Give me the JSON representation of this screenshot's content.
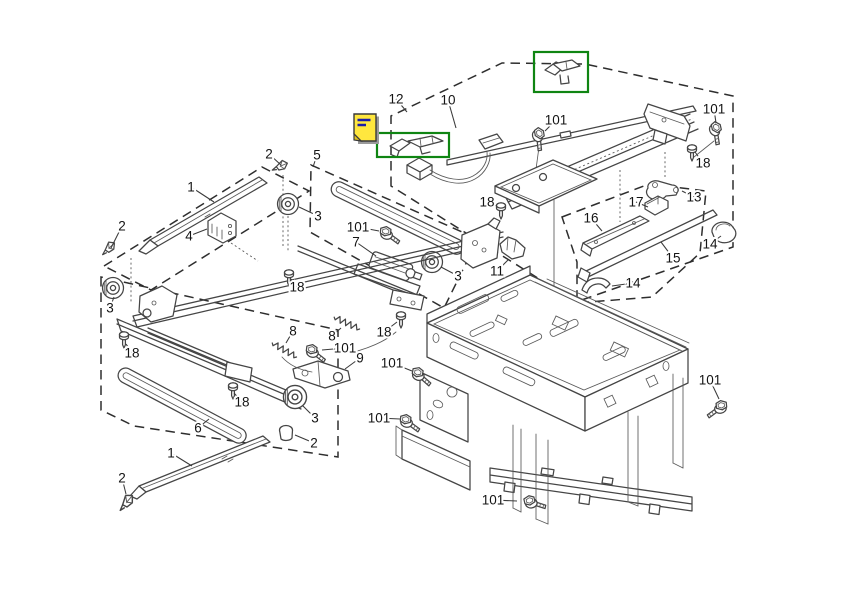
{
  "diagram": {
    "canvas": {
      "width": 842,
      "height": 595,
      "background": "#ffffff",
      "line_color": "#454545",
      "dash_color": "#2e2e2e"
    },
    "highlight_color": "#0f8512",
    "note_icon": {
      "name": "sticky-note-icon",
      "fill": "#ffe73e",
      "shadow": "#9a9a9a",
      "line_color": "#1c1ca8",
      "x": 354,
      "y": 114
    },
    "highlight_boxes": [
      {
        "x": 534,
        "y": 52,
        "w": 54,
        "h": 40
      },
      {
        "x": 377,
        "y": 133,
        "w": 72,
        "h": 24
      }
    ],
    "part_numbers_shown": [
      "1",
      "2",
      "3",
      "4",
      "5",
      "6",
      "7",
      "8",
      "9",
      "10",
      "11",
      "12",
      "13",
      "14",
      "15",
      "16",
      "17",
      "18",
      "101"
    ],
    "callouts": [
      {
        "text": "12",
        "x": 396,
        "y": 99,
        "lx": 407,
        "ly": 112
      },
      {
        "text": "10",
        "x": 448,
        "y": 100,
        "lx": 456,
        "ly": 128
      },
      {
        "text": "101",
        "x": 556,
        "y": 120,
        "lx": 545,
        "ly": 131
      },
      {
        "text": "101",
        "x": 714,
        "y": 109,
        "lx": 716,
        "ly": 123
      },
      {
        "text": "18",
        "x": 703,
        "y": 163,
        "lx": 695,
        "ly": 152
      },
      {
        "text": "2",
        "x": 269,
        "y": 154,
        "lx": 281,
        "ly": 165
      },
      {
        "text": "5",
        "x": 317,
        "y": 155,
        "lx": 313,
        "ly": 167
      },
      {
        "text": "1",
        "x": 191,
        "y": 187,
        "lx": 214,
        "ly": 202
      },
      {
        "text": "18",
        "x": 487,
        "y": 202,
        "lx": 497,
        "ly": 206
      },
      {
        "text": "13",
        "x": 694,
        "y": 197,
        "lx": 682,
        "ly": 191
      },
      {
        "text": "17",
        "x": 636,
        "y": 202,
        "lx": 648,
        "ly": 207
      },
      {
        "text": "3",
        "x": 318,
        "y": 216,
        "lx": 299,
        "ly": 207
      },
      {
        "text": "16",
        "x": 591,
        "y": 218,
        "lx": 602,
        "ly": 231
      },
      {
        "text": "2",
        "x": 122,
        "y": 226,
        "lx": 111,
        "ly": 248
      },
      {
        "text": "101",
        "x": 358,
        "y": 227,
        "lx": 379,
        "ly": 231
      },
      {
        "text": "4",
        "x": 189,
        "y": 236,
        "lx": 207,
        "ly": 229
      },
      {
        "text": "7",
        "x": 356,
        "y": 242,
        "lx": 376,
        "ly": 256
      },
      {
        "text": "14",
        "x": 710,
        "y": 244,
        "lx": 721,
        "ly": 236
      },
      {
        "text": "15",
        "x": 673,
        "y": 258,
        "lx": 661,
        "ly": 242
      },
      {
        "text": "11",
        "x": 497,
        "y": 271,
        "lx": 508,
        "ly": 260
      },
      {
        "text": "3",
        "x": 458,
        "y": 276,
        "lx": 441,
        "ly": 267
      },
      {
        "text": "14",
        "x": 633,
        "y": 283,
        "lx": 612,
        "ly": 286
      },
      {
        "text": "18",
        "x": 297,
        "y": 287,
        "lx": 291,
        "ly": 279
      },
      {
        "text": "3",
        "x": 110,
        "y": 308,
        "lx": 114,
        "ly": 297
      },
      {
        "text": "8",
        "x": 293,
        "y": 331,
        "lx": 286,
        "ly": 343
      },
      {
        "text": "8",
        "x": 332,
        "y": 336,
        "lx": 341,
        "ly": 328
      },
      {
        "text": "18",
        "x": 384,
        "y": 332,
        "lx": 397,
        "ly": 322
      },
      {
        "text": "101",
        "x": 345,
        "y": 348,
        "lx": 322,
        "ly": 350
      },
      {
        "text": "18",
        "x": 132,
        "y": 353,
        "lx": 126,
        "ly": 344
      },
      {
        "text": "9",
        "x": 360,
        "y": 358,
        "lx": 345,
        "ly": 369
      },
      {
        "text": "101",
        "x": 392,
        "y": 363,
        "lx": 412,
        "ly": 371
      },
      {
        "text": "18",
        "x": 242,
        "y": 402,
        "lx": 234,
        "ly": 393
      },
      {
        "text": "3",
        "x": 315,
        "y": 418,
        "lx": 303,
        "ly": 406
      },
      {
        "text": "101",
        "x": 379,
        "y": 418,
        "lx": 400,
        "ly": 419
      },
      {
        "text": "101",
        "x": 710,
        "y": 380,
        "lx": 719,
        "ly": 399
      },
      {
        "text": "6",
        "x": 198,
        "y": 428,
        "lx": 209,
        "ly": 419
      },
      {
        "text": "2",
        "x": 314,
        "y": 443,
        "lx": 295,
        "ly": 435
      },
      {
        "text": "1",
        "x": 171,
        "y": 453,
        "lx": 192,
        "ly": 466
      },
      {
        "text": "2",
        "x": 122,
        "y": 478,
        "lx": 126,
        "ly": 494
      },
      {
        "text": "101",
        "x": 493,
        "y": 500,
        "lx": 517,
        "ly": 501
      }
    ]
  }
}
